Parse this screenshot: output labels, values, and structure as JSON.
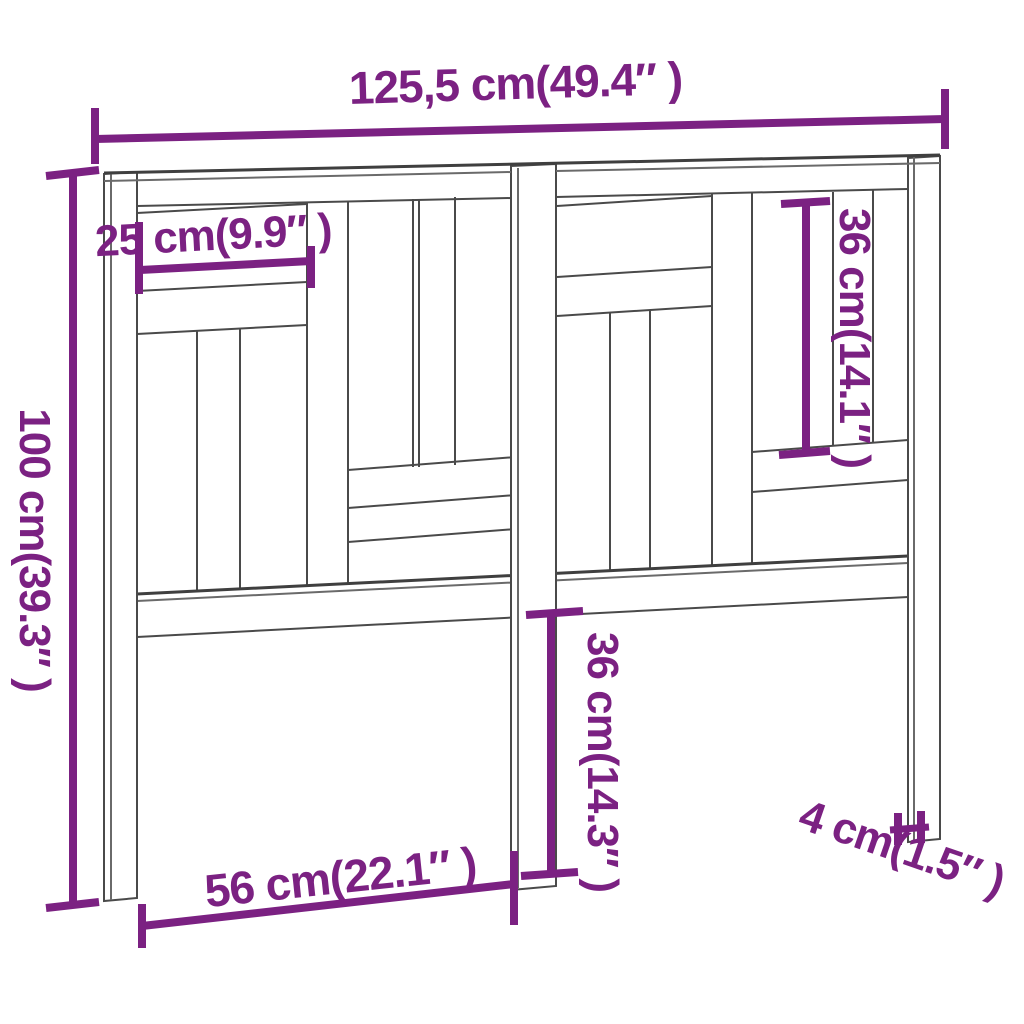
{
  "figure": {
    "title": "bed-headboard-dimension-diagram",
    "subject": "wooden slatted bed headboard, three legs, perspective line drawing",
    "accent_color": "#7b2182",
    "line_color": "#4a4a4a",
    "background_color": "#ffffff",
    "dimensions": {
      "total_width": "125,5 cm(49.4″ )",
      "total_height": "100 cm(39.3″ )",
      "top_board_length": "25 cm(9.9″ )",
      "upper_panel_height": "36 cm(14.1″ )",
      "leg_height": "36 cm(14.3″ )",
      "leg_spacing": "56 cm(22.1″ )",
      "leg_thickness": "4 cm(1.5″ )"
    }
  }
}
